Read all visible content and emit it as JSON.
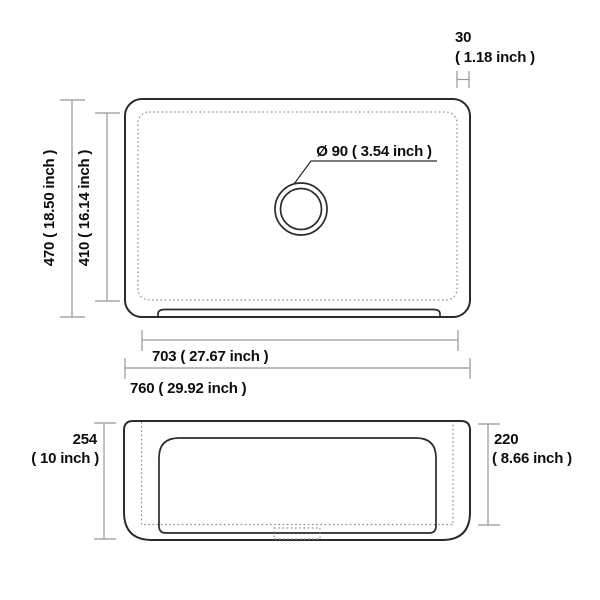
{
  "drawing": {
    "kind": "sink-dimension-diagram",
    "views": {
      "top_view": "plan view of sink with center drain",
      "front_view": "front elevation of apron sink"
    },
    "dimensions": {
      "rim_offset": {
        "value": "30",
        "inch": "( 1.18 inch )"
      },
      "drain_diameter": {
        "label": "Ø 90 ( 3.54 inch )"
      },
      "outer_depth": {
        "label": "470 ( 18.50 inch )"
      },
      "inner_depth": {
        "label": "410 ( 16.14 inch )"
      },
      "inner_width": {
        "label": "703 ( 27.67 inch )"
      },
      "outer_width": {
        "label": "760 ( 29.92 inch )"
      },
      "front_height": {
        "value": "254",
        "inch": "( 10 inch )"
      },
      "bowl_depth": {
        "value": "220",
        "inch": "( 8.66 inch )"
      }
    },
    "colors": {
      "background": "#ffffff",
      "drawing_line": "#2b2b2b",
      "hidden_line": "#8f8f8f",
      "dimension_line": "#979797",
      "text": "#0d0d0d"
    }
  }
}
